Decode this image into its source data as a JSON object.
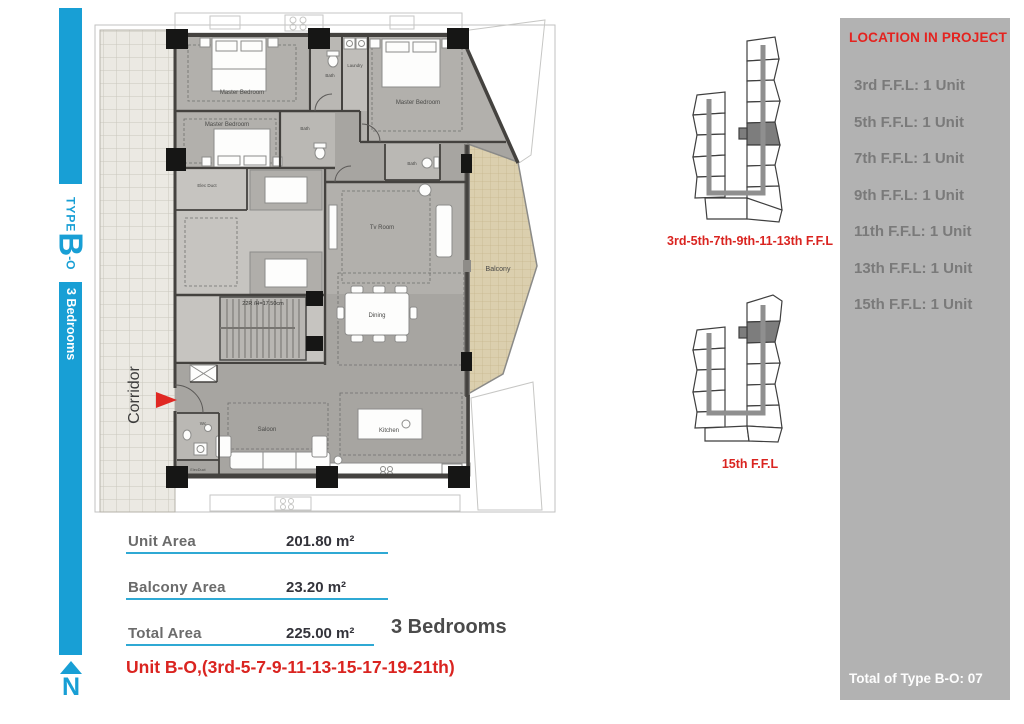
{
  "side_tab": {
    "type_word": "TYPE",
    "type_letter": "B",
    "type_suffix": "-O",
    "bedrooms": "3 Bedrooms",
    "north": "N"
  },
  "plan": {
    "labels": {
      "corridor": "Corridor",
      "master_bedroom": "Master Bedroom",
      "bath": "Bath",
      "laundry": "Laundry",
      "tv_room": "Tv Room",
      "dining": "Dining",
      "kitchen": "Kitchen",
      "saloon": "Saloon",
      "wc": "Wc",
      "elec_duct": "Elec Duct",
      "elec_duct_small": "ElecDuct",
      "balcony": "Balcony",
      "stair_note": "22R /H=17.50cm"
    }
  },
  "key_plans": [
    {
      "label": "3rd-5th-7th-9th-11-13th F.F.L"
    },
    {
      "label": "15th F.F.L"
    }
  ],
  "location_panel": {
    "title": "LOCATION IN PROJECT",
    "items": [
      "3rd F.F.L:  1 Unit",
      "5th F.F.L:  1 Unit",
      "7th F.F.L:  1 Unit",
      "9th F.F.L: 1 Unit",
      "11th F.F.L: 1 Unit",
      "13th F.F.L: 1 Unit",
      "15th F.F.L: 1 Unit"
    ],
    "total": "Total of Type B-O: 07"
  },
  "areas": {
    "rows": [
      {
        "label": "Unit Area",
        "value": "201.80 m²"
      },
      {
        "label": "Balcony Area",
        "value": "23.20 m²"
      },
      {
        "label": "Total Area",
        "value": "225.00 m²"
      }
    ],
    "bedrooms_title": "3 Bedrooms",
    "unit_note": "Unit B-O,(3rd-5-7-9-11-13-15-17-19-21th)"
  },
  "colors": {
    "cyan": "#189fd5",
    "red": "#da2420",
    "panel_bg": "#b2b2b2",
    "panel_text": "#7a7a7a",
    "plan_floor": "#a7a5a1",
    "balcony_tan": "#dbcfae"
  }
}
